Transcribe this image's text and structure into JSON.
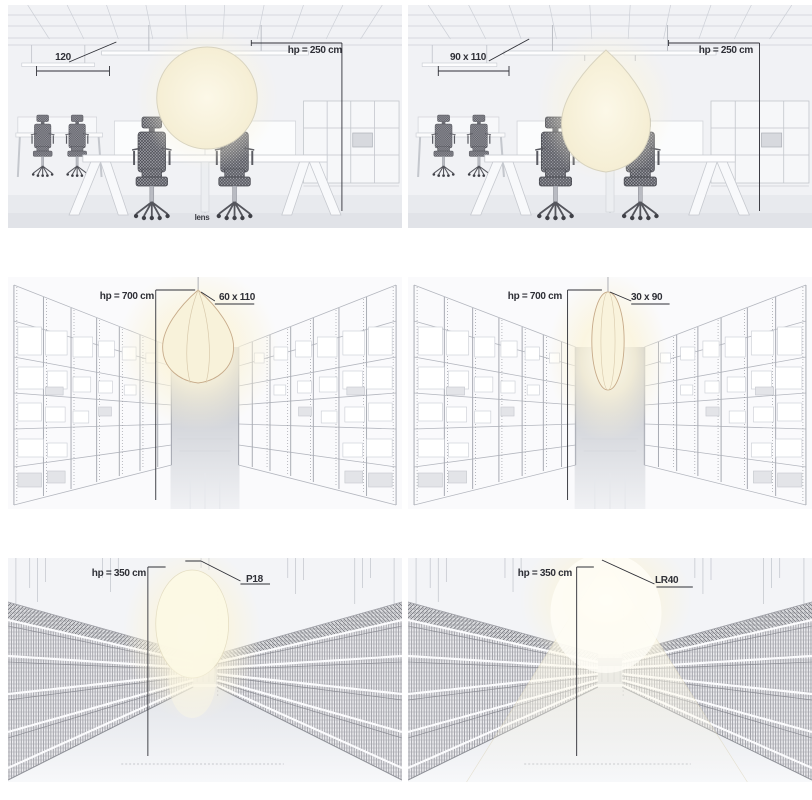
{
  "panels": [
    {
      "scene": "office",
      "lamp": "sphere",
      "size_label": "120",
      "height_label": "hp = 250 cm",
      "caption": "lens"
    },
    {
      "scene": "office",
      "lamp": "drop",
      "size_label": "90 x 110",
      "height_label": "hp = 250 cm"
    },
    {
      "scene": "warehouse",
      "lamp": "drop",
      "size_label": "60 x 110",
      "height_label": "hp = 700 cm"
    },
    {
      "scene": "warehouse",
      "lamp": "ellipse",
      "size_label": "30 x 90",
      "height_label": "hp = 700 cm"
    },
    {
      "scene": "supermarket",
      "lamp": "sphere",
      "size_label": "P18",
      "height_label": "hp = 350 cm"
    },
    {
      "scene": "supermarket",
      "lamp": "cone",
      "size_label": "LR40",
      "height_label": "hp = 350 cm"
    }
  ],
  "colors": {
    "wall": "#f1f2f5",
    "line_art": "#b9bcc4",
    "lamp_fill": "#f8f2da",
    "lamp_glow": "#fbf4da",
    "dimension_line": "#2e2f36"
  }
}
